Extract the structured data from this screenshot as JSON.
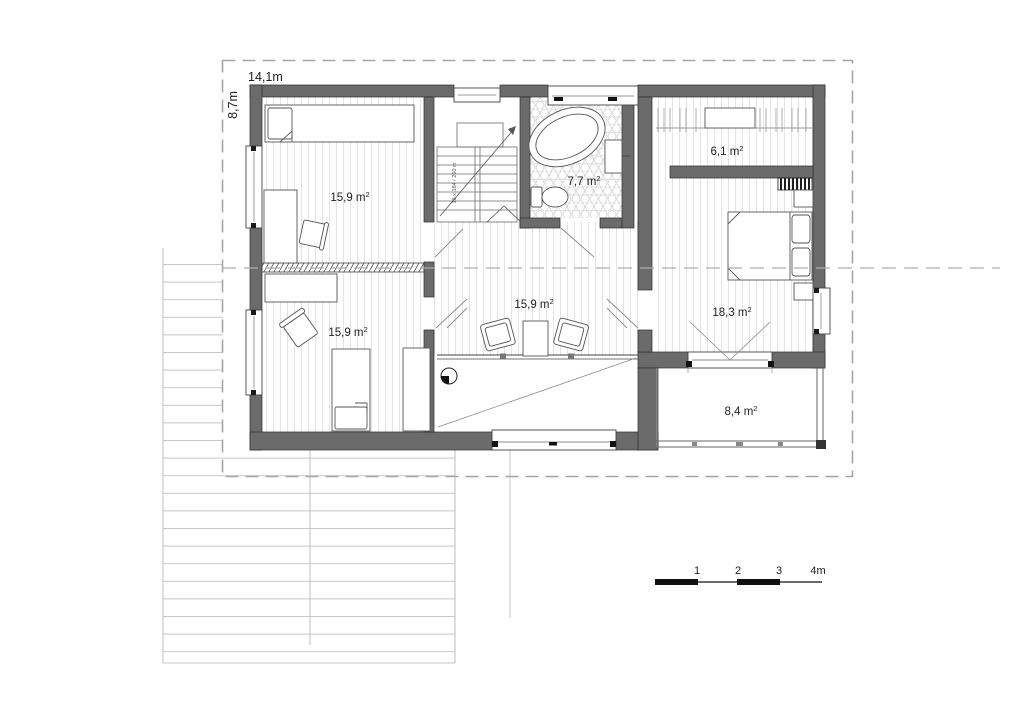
{
  "boundary_dimensions": {
    "width_label": "14,1m",
    "height_label": "8,7m"
  },
  "rooms": [
    {
      "name": "bedroom-top-left",
      "label": "15,9 m",
      "sup": "2"
    },
    {
      "name": "bathroom",
      "label": "7,7 m",
      "sup": "2"
    },
    {
      "name": "wardrobe",
      "label": "6,1 m",
      "sup": "2"
    },
    {
      "name": "hall-landing",
      "label": "15,9 m",
      "sup": "2"
    },
    {
      "name": "bedroom-right",
      "label": "18,3 m",
      "sup": "2"
    },
    {
      "name": "bedroom-bottom-left",
      "label": "15,9 m",
      "sup": "2"
    },
    {
      "name": "balcony",
      "label": "8,4 m",
      "sup": "2"
    }
  ],
  "stairs": {
    "annotation": "16 x 184 / 260 m"
  },
  "scale_bar": {
    "ticks": [
      "1",
      "2",
      "3",
      "4m"
    ]
  },
  "colors": {
    "wall": "#6b6b6b",
    "dash": "#a6a6a6",
    "floor_line": "#dedede"
  }
}
